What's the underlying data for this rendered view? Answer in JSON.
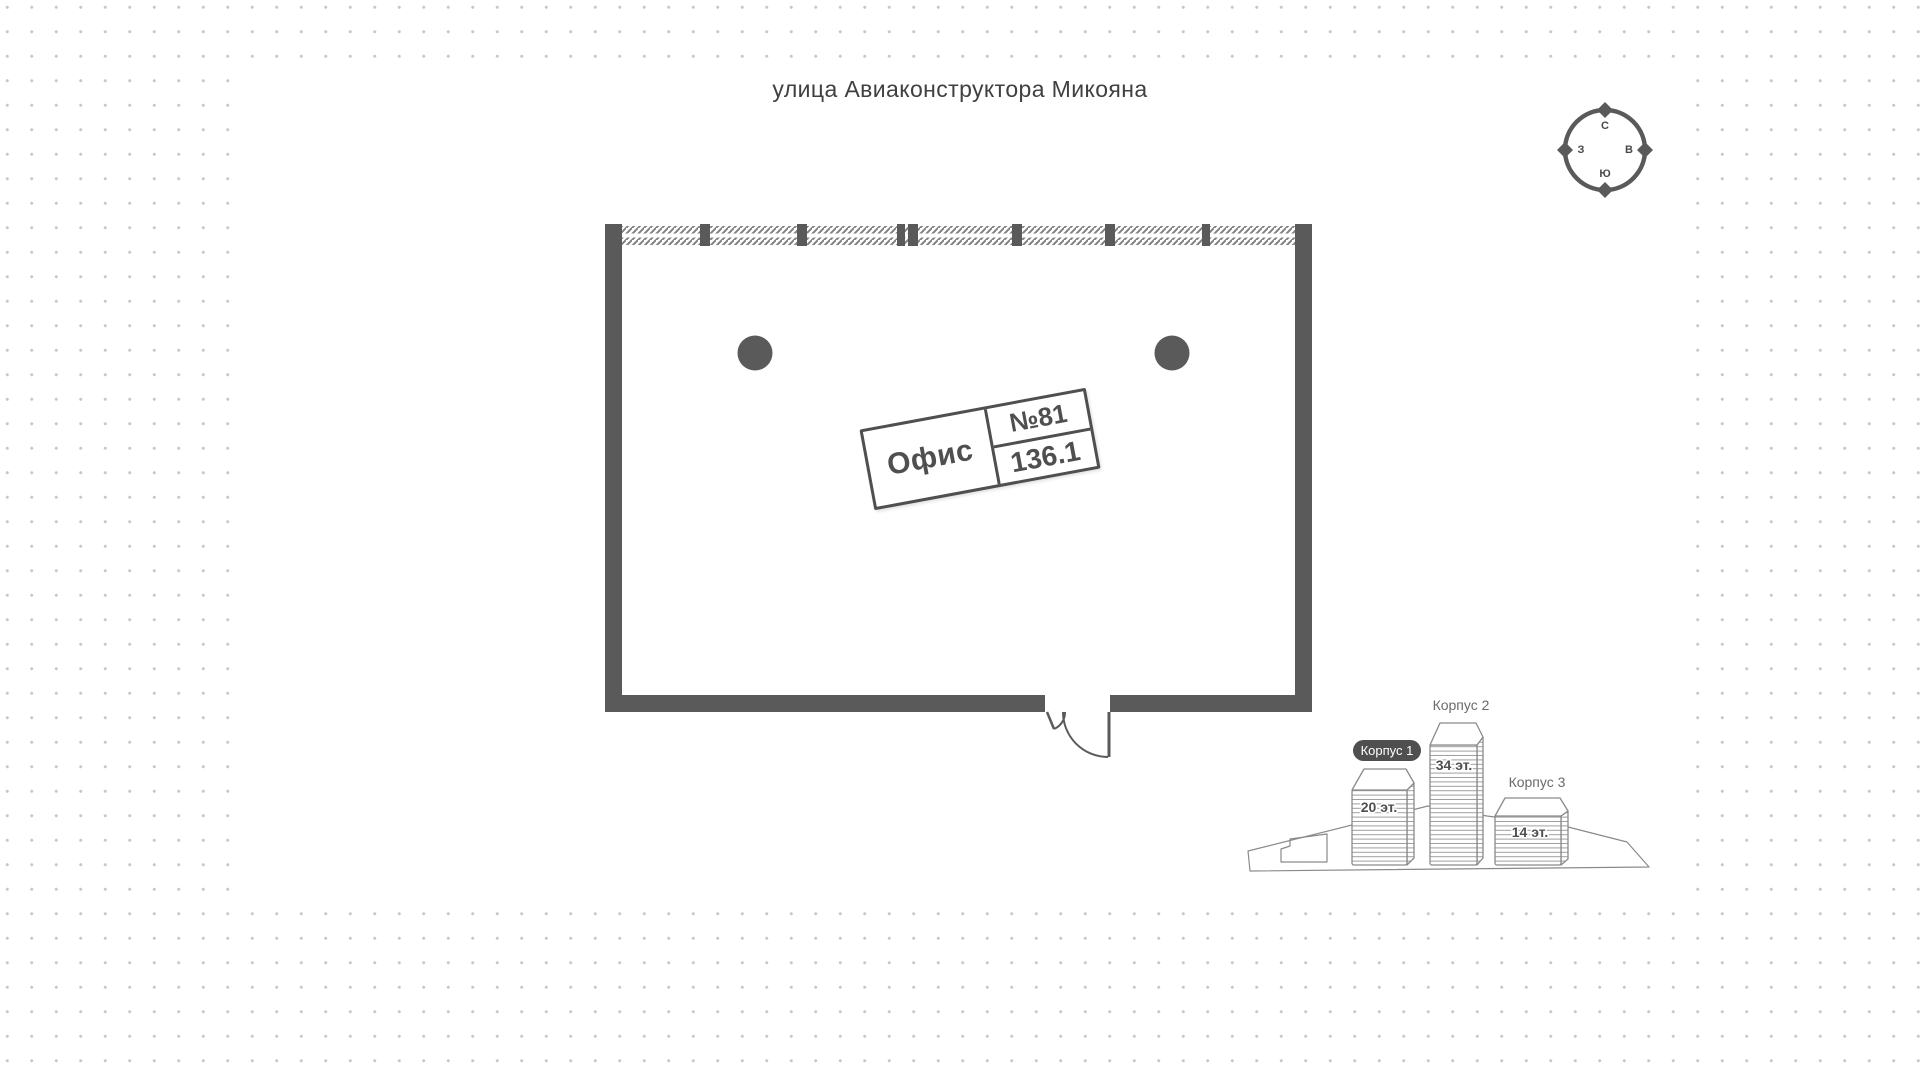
{
  "street": {
    "label": "улица Авиаконструктора Микояна"
  },
  "compass": {
    "n": "С",
    "e": "В",
    "s": "Ю",
    "w": "З"
  },
  "unit": {
    "type_label": "Офис",
    "number": "№81",
    "area": "136.1"
  },
  "buildings": {
    "items": [
      {
        "name": "Корпус 1",
        "floors": "20 эт.",
        "selected": true
      },
      {
        "name": "Корпус 2",
        "floors": "34 эт.",
        "selected": false
      },
      {
        "name": "Корпус 3",
        "floors": "14 эт.",
        "selected": false
      }
    ]
  },
  "colors": {
    "wall": "#5a5a5a",
    "selected_badge": "#4f4f4f",
    "dot_grid": "#c9c9c9"
  }
}
